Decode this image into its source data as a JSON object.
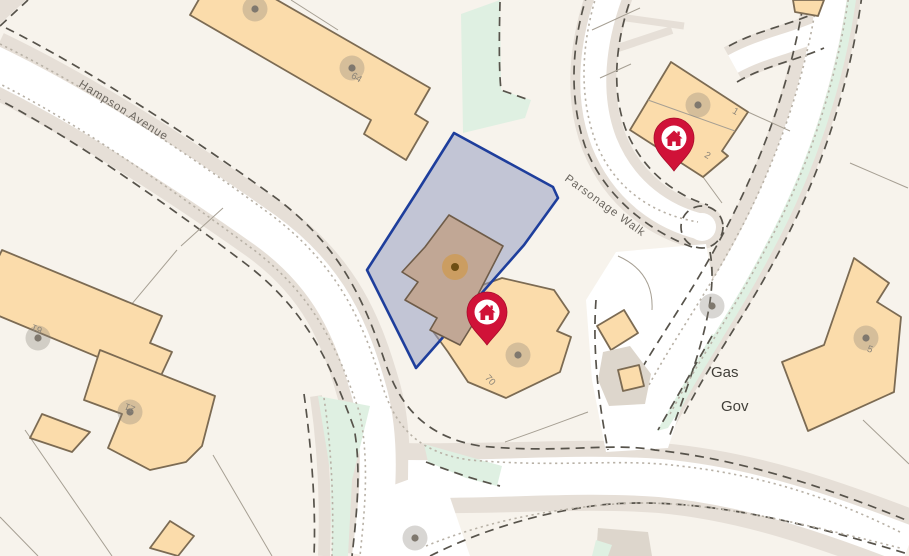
{
  "map": {
    "street_labels": [
      {
        "text": "Hampson Avenue"
      },
      {
        "text": "Parsonage Walk"
      }
    ],
    "area_labels": [
      {
        "text": "Gas"
      },
      {
        "text": "Gov"
      }
    ],
    "plot_numbers": [
      {
        "text": "64"
      },
      {
        "text": "61"
      },
      {
        "text": "21"
      },
      {
        "text": "70"
      },
      {
        "text": "1"
      },
      {
        "text": "2"
      },
      {
        "text": "5"
      }
    ],
    "markers": [
      {
        "name": "property-pin-1"
      },
      {
        "name": "property-pin-2"
      }
    ],
    "colors": {
      "bg": "#f7f3ec",
      "road": "#e6dfd7",
      "white": "#ffffff",
      "dash": "#57534b",
      "dot": "#b8b1a6",
      "green": "#dff0e2",
      "bldg": "#fbdcab",
      "bldgstroke": "#7c6b53",
      "bldg2": "#c1a795",
      "bldg2stroke": "#6e5c49",
      "parcelfill": "rgba(151,159,194,0.55)",
      "parcelstroke": "#1e3e9c",
      "pline": "#a69f93",
      "lbl": "#6b665f",
      "num": "#8b8478",
      "area": "#403e38",
      "pin": "#d01238"
    }
  }
}
